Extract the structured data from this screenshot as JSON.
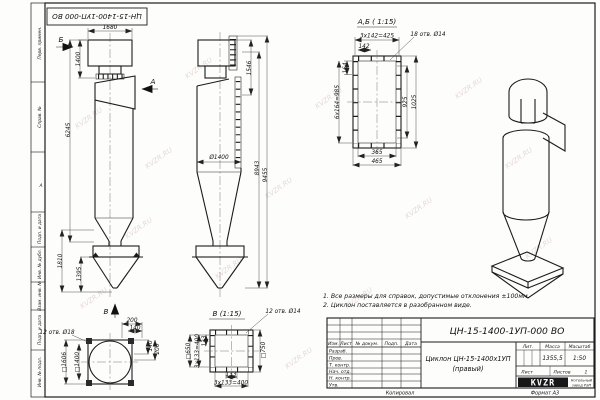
{
  "watermark": "KVZR.RU",
  "stamp": {
    "doc_number_top": "ЦН-15-1400-1УП-000 ВО"
  },
  "margin": {
    "labels": [
      "Перв. примен.",
      "Справ. №",
      "Подп. и дата",
      "Инв. № дубл.",
      "Взам. инв. №",
      "Подп. и дата",
      "Инв. № подл."
    ],
    "zone": "А"
  },
  "front": {
    "view_b": "Б",
    "view_a": "А",
    "view_v": "В",
    "dim_1680": "1680",
    "dim_1400": "1400",
    "dim_6245": "6245",
    "dim_1810": "1810",
    "dim_1395": "1395"
  },
  "side": {
    "dim_1546": "1546",
    "dim_dia": "Ø1400",
    "dim_8943": "8943",
    "dim_9455": "9455"
  },
  "detail_ab": {
    "title": "А,Б ( 1:15)",
    "dim_total_top": "3x142=425",
    "dim_142": "142",
    "holes": "18 отв. Ø14",
    "dim_164": "164",
    "dim_total_left": "6x164=985",
    "dim_925": "925",
    "dim_1025": "1025",
    "dim_365": "365",
    "dim_465": "465"
  },
  "view_v": {
    "holes": "12 отв. Ø18",
    "dim_sq_outer": "□1606",
    "dim_sq_inner": "□1400",
    "dim_200_top": "200",
    "dim_140_top": "140",
    "dim_140_side": "140",
    "dim_200_side": "200"
  },
  "detail_v": {
    "title": "В (1:15)",
    "holes": "12 отв. Ø14",
    "dim_sq_left": "□650",
    "dim_sq_right": "□750",
    "dim_total_left": "3x133=400",
    "dim_133_left": "133",
    "dim_133_bottom": "133",
    "dim_total_bottom": "3x133=400"
  },
  "notes": {
    "line1": "1. Все размеры для справок, допустимые отклонения ±100мм.",
    "line2": "2. Циклон поставляется в разобранном виде."
  },
  "title_block": {
    "doc_number": "ЦН-15-1400-1УП-000 ВО",
    "product_name": "Циклон ЦН-15-1400х1УП",
    "product_variant": "(правый)",
    "col_izm": "Изм.",
    "col_list": "Лист",
    "col_doc": "№ докум.",
    "col_podp": "Подп.",
    "col_data": "Дата",
    "row_1": "Разраб.",
    "row_2": "Пров.",
    "row_3": "Т. контр.",
    "row_4": "Нач. отд.",
    "row_5": "Н. контр.",
    "row_6": "Утв.",
    "lit_label": "Лит.",
    "mass_label": "Масса",
    "scale_label": "Масштаб",
    "mass_value": "1355,5",
    "scale_value": "1:50",
    "list_label": "Лист",
    "listov_label": "Листов",
    "listov_value": "1",
    "logo_text": "KVZR",
    "company_line1": "Котельный",
    "company_line2": "завод РЭП",
    "copied": "Копировал",
    "format": "Формат А3"
  }
}
